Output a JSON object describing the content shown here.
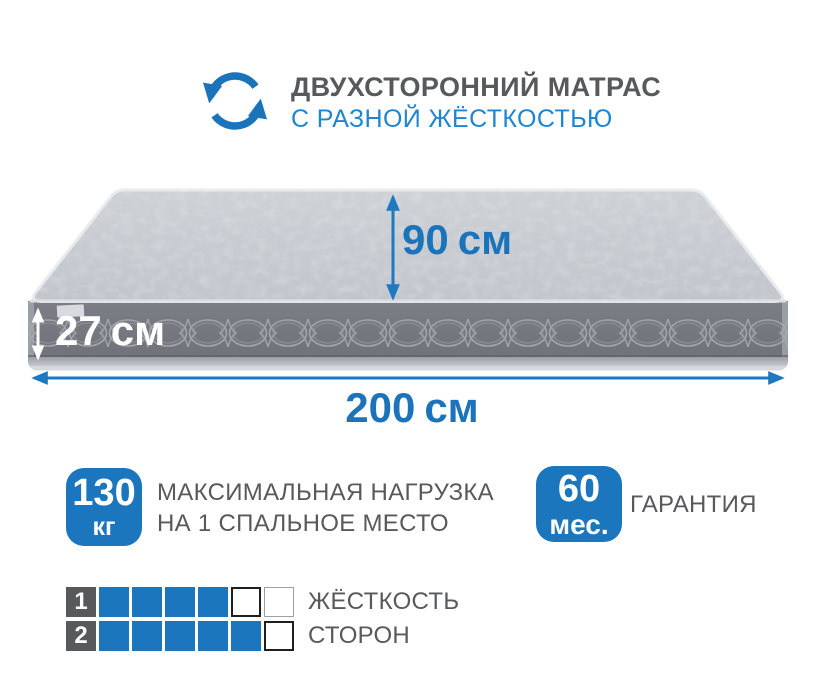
{
  "header": {
    "title": "ДВУХСТОРОННИЙ МАТРАС",
    "subtitle": "С РАЗНОЙ ЖЁСТКОСТЬЮ",
    "icon": "rotate-arrows-icon"
  },
  "dimensions": {
    "height": {
      "value": "90",
      "unit": "см"
    },
    "thickness": {
      "value": "27",
      "unit": "см"
    },
    "width": {
      "value": "200",
      "unit": "см"
    }
  },
  "features": {
    "max_load": {
      "value": "130",
      "unit": "кг",
      "label_line1": "МАКСИМАЛЬНАЯ НАГРУЗКА",
      "label_line2": "НА 1 СПАЛЬНОЕ МЕСТО"
    },
    "warranty": {
      "value": "60",
      "unit": "мес.",
      "label": "ГАРАНТИЯ"
    }
  },
  "firmness_scale": {
    "label_line1": "ЖЁСТКОСТЬ",
    "label_line2": "СТОРОН",
    "total_cells_per_row": 6,
    "rows": [
      {
        "number": "1",
        "filled": 4,
        "empty_styles": [
          "strong",
          "light"
        ]
      },
      {
        "number": "2",
        "filled": 5,
        "empty_styles": [
          "strong"
        ]
      }
    ]
  },
  "colors": {
    "blue": "#1b74ba",
    "light_blue": "#1e86d0",
    "dark_gray": "#58595b",
    "cell_blue": "#1b76bd",
    "mattress_top": "#c8ccd2",
    "mattress_side": "#74777e"
  }
}
